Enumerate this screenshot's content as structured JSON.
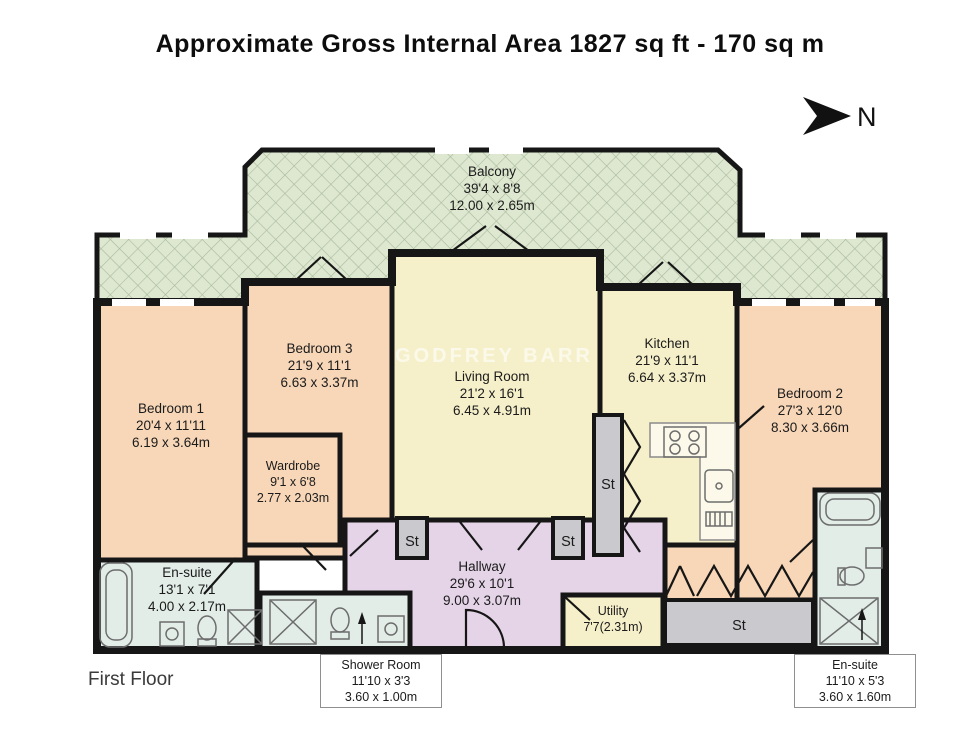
{
  "title": "Approximate Gross Internal Area 1827 sq ft - 170 sq m",
  "floor_label": "First Floor",
  "compass_label": "N",
  "watermark": "GODFREY BARR",
  "storage_label": "St",
  "colors": {
    "balcony_green": "#dee8d1",
    "hatch_line": "#aab99c",
    "bedroom_peach": "#f8d7b8",
    "living_yellow": "#f6f0ca",
    "hallway_lavender": "#e5d4e8",
    "bathroom_blue": "#e2ede8",
    "storage_grey": "#c9c9ce",
    "wall_black": "#161616"
  },
  "rooms": {
    "balcony": {
      "name": "Balcony",
      "imperial": "39'4 x 8'8",
      "metric": "12.00 x 2.65m"
    },
    "bedroom1": {
      "name": "Bedroom 1",
      "imperial": "20'4 x 11'11",
      "metric": "6.19 x 3.64m"
    },
    "bedroom2": {
      "name": "Bedroom 2",
      "imperial": "27'3 x 12'0",
      "metric": "8.30 x 3.66m"
    },
    "bedroom3": {
      "name": "Bedroom 3",
      "imperial": "21'9 x 11'1",
      "metric": "6.63 x 3.37m"
    },
    "living_room": {
      "name": "Living Room",
      "imperial": "21'2 x 16'1",
      "metric": "6.45 x 4.91m"
    },
    "kitchen": {
      "name": "Kitchen",
      "imperial": "21'9 x 11'1",
      "metric": "6.64 x 3.37m"
    },
    "wardrobe": {
      "name": "Wardrobe",
      "imperial": "9'1 x 6'8",
      "metric": "2.77 x 2.03m"
    },
    "hallway": {
      "name": "Hallway",
      "imperial": "29'6 x 10'1",
      "metric": "9.00 x 3.07m"
    },
    "ensuite_left": {
      "name": "En-suite",
      "imperial": "13'1 x 7'1",
      "metric": "4.00 x 2.17m"
    },
    "utility": {
      "name": "Utility",
      "dims": "7'7(2.31m)"
    },
    "shower_room": {
      "name": "Shower Room",
      "imperial": "11'10 x 3'3",
      "metric": "3.60 x 1.00m"
    },
    "ensuite_right": {
      "name": "En-suite",
      "imperial": "11'10 x 5'3",
      "metric": "3.60 x 1.60m"
    }
  }
}
